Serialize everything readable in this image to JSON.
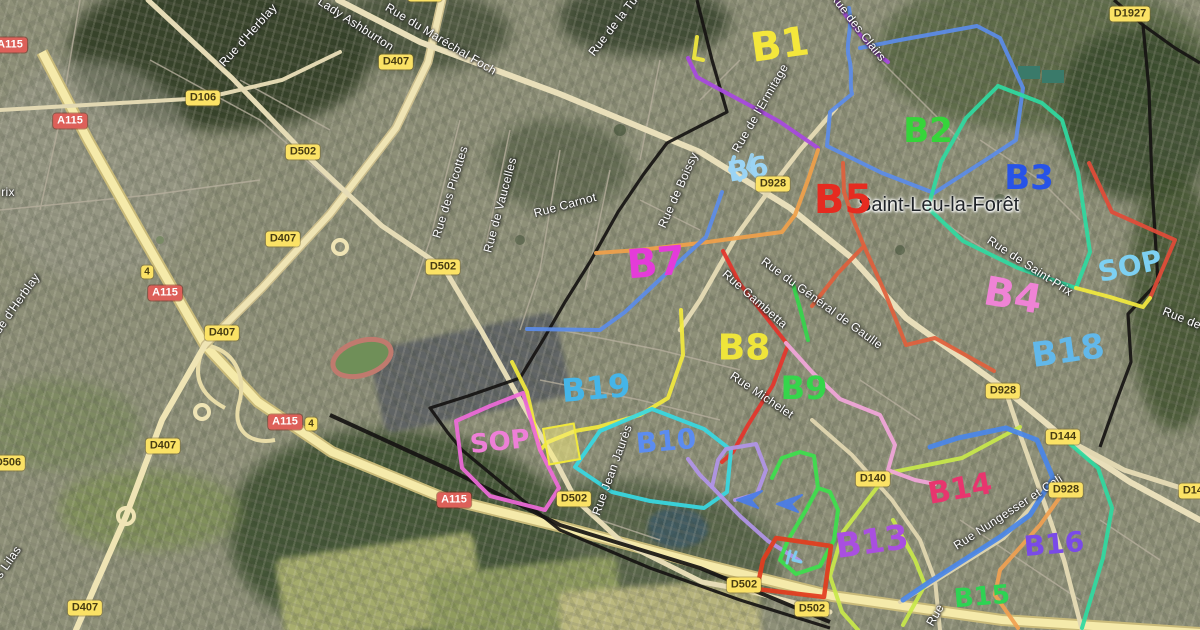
{
  "map": {
    "town_label": "Saint-Leu-la-Forêt",
    "road_badges": [
      {
        "text": "A115",
        "kind": "a",
        "x": 10,
        "y": 45
      },
      {
        "text": "D1927",
        "kind": "d",
        "x": 1130,
        "y": 14
      },
      {
        "text": "D106",
        "kind": "d",
        "x": 203,
        "y": 98
      },
      {
        "text": "A115",
        "kind": "a",
        "x": 70,
        "y": 121
      },
      {
        "text": "D502",
        "kind": "d",
        "x": 303,
        "y": 152
      },
      {
        "text": "D407",
        "kind": "d",
        "x": 396,
        "y": 62
      },
      {
        "text": "D407",
        "kind": "d",
        "x": 425,
        "y": -6
      },
      {
        "text": "D928",
        "kind": "d",
        "x": 773,
        "y": 184
      },
      {
        "text": "D407",
        "kind": "d",
        "x": 283,
        "y": 239
      },
      {
        "text": "D502",
        "kind": "d",
        "x": 443,
        "y": 267
      },
      {
        "text": "4",
        "kind": "sq",
        "x": 147,
        "y": 272
      },
      {
        "text": "A115",
        "kind": "a",
        "x": 165,
        "y": 293
      },
      {
        "text": "D407",
        "kind": "d",
        "x": 222,
        "y": 333
      },
      {
        "text": "A115",
        "kind": "a",
        "x": 285,
        "y": 422
      },
      {
        "text": "4",
        "kind": "sq",
        "x": 311,
        "y": 424
      },
      {
        "text": "D407",
        "kind": "d",
        "x": 163,
        "y": 446
      },
      {
        "text": "D506",
        "kind": "d",
        "x": 8,
        "y": 463
      },
      {
        "text": "D140",
        "kind": "d",
        "x": 873,
        "y": 479
      },
      {
        "text": "A115",
        "kind": "a",
        "x": 454,
        "y": 500
      },
      {
        "text": "D502",
        "kind": "d",
        "x": 574,
        "y": 499
      },
      {
        "text": "D502",
        "kind": "d",
        "x": 744,
        "y": 585
      },
      {
        "text": "D502",
        "kind": "d",
        "x": 812,
        "y": 609
      },
      {
        "text": "D407",
        "kind": "d",
        "x": 85,
        "y": 608
      },
      {
        "text": "D928",
        "kind": "d",
        "x": 1003,
        "y": 391
      },
      {
        "text": "D144",
        "kind": "d",
        "x": 1063,
        "y": 437
      },
      {
        "text": "D928",
        "kind": "d",
        "x": 1066,
        "y": 490
      },
      {
        "text": "D144",
        "kind": "d",
        "x": 1196,
        "y": 491
      }
    ],
    "street_labels": [
      {
        "text": "Lady Ashburton",
        "x": 356,
        "y": 24,
        "rot": 33
      },
      {
        "text": "Rue du Maréchal Foch",
        "x": 441,
        "y": 39,
        "rot": 31
      },
      {
        "text": "Rue de la Tu",
        "x": 613,
        "y": 26,
        "rot": -52
      },
      {
        "text": "Rue d'Herblay",
        "x": 248,
        "y": 35,
        "rot": -48
      },
      {
        "text": "Rue d'Herblay",
        "x": 14,
        "y": 307,
        "rot": -55
      },
      {
        "text": "rix",
        "x": 8,
        "y": 192,
        "rot": 0
      },
      {
        "text": "Rue des Picottes",
        "x": 450,
        "y": 192,
        "rot": -73
      },
      {
        "text": "Rue de Vaucelles",
        "x": 500,
        "y": 205,
        "rot": -75
      },
      {
        "text": "Rue Carnot",
        "x": 565,
        "y": 205,
        "rot": -15
      },
      {
        "text": "Rue de Boissy",
        "x": 678,
        "y": 190,
        "rot": -66
      },
      {
        "text": "Rue de l'Ermitage",
        "x": 760,
        "y": 108,
        "rot": -60
      },
      {
        "text": "Rue des Clairs",
        "x": 858,
        "y": 27,
        "rot": 52
      },
      {
        "text": "Rue du Général de Gaulle",
        "x": 822,
        "y": 303,
        "rot": 36
      },
      {
        "text": "Rue Gambetta",
        "x": 755,
        "y": 299,
        "rot": 41
      },
      {
        "text": "Rue de Saint-Prix",
        "x": 1030,
        "y": 266,
        "rot": 33
      },
      {
        "text": "Rue de",
        "x": 1182,
        "y": 318,
        "rot": 22
      },
      {
        "text": "Rue Michelet",
        "x": 762,
        "y": 395,
        "rot": 34
      },
      {
        "text": "Rue Jean Jaurès",
        "x": 612,
        "y": 470,
        "rot": -70
      },
      {
        "text": "Rue Nungesser et Coli",
        "x": 1008,
        "y": 512,
        "rot": -33
      },
      {
        "text": "s Lilas",
        "x": 8,
        "y": 562,
        "rot": -55
      },
      {
        "text": "Rue",
        "x": 935,
        "y": 615,
        "rot": -60
      }
    ],
    "route_labels": [
      {
        "text": "B1",
        "color": "#f4e73b",
        "x": 780,
        "y": 45,
        "size": 40,
        "rot": -8
      },
      {
        "text": "B2",
        "color": "#35d53a",
        "x": 928,
        "y": 131,
        "size": 34,
        "rot": 0
      },
      {
        "text": "B3",
        "color": "#2753e8",
        "x": 1029,
        "y": 178,
        "size": 34,
        "rot": 0
      },
      {
        "text": "B4",
        "color": "#ef83d5",
        "x": 1013,
        "y": 296,
        "size": 40,
        "rot": 10
      },
      {
        "text": "B5",
        "color": "#e62b20",
        "x": 843,
        "y": 200,
        "size": 40,
        "rot": 0
      },
      {
        "text": "B6",
        "color": "#9bd4f5",
        "x": 748,
        "y": 169,
        "size": 28,
        "rot": -10
      },
      {
        "text": "B7",
        "color": "#e43bd9",
        "x": 656,
        "y": 263,
        "size": 40,
        "rot": -5
      },
      {
        "text": "B8",
        "color": "#efe53a",
        "x": 744,
        "y": 348,
        "size": 36,
        "rot": 0
      },
      {
        "text": "B9",
        "color": "#35d54b",
        "x": 804,
        "y": 388,
        "size": 32,
        "rot": 0
      },
      {
        "text": "B10",
        "color": "#5b8cf0",
        "x": 666,
        "y": 441,
        "size": 28,
        "rot": -5
      },
      {
        "text": "B13",
        "color": "#a94fe0",
        "x": 872,
        "y": 542,
        "size": 34,
        "rot": -8
      },
      {
        "text": "B14",
        "color": "#e8356e",
        "x": 960,
        "y": 489,
        "size": 30,
        "rot": -10
      },
      {
        "text": "B15",
        "color": "#2ed353",
        "x": 982,
        "y": 597,
        "size": 26,
        "rot": -5
      },
      {
        "text": "B16",
        "color": "#7a4ae8",
        "x": 1054,
        "y": 544,
        "size": 28,
        "rot": -5
      },
      {
        "text": "B18",
        "color": "#62b8ea",
        "x": 1068,
        "y": 351,
        "size": 34,
        "rot": -8
      },
      {
        "text": "B19",
        "color": "#45b5e8",
        "x": 596,
        "y": 388,
        "size": 32,
        "rot": -5
      },
      {
        "text": "SOP",
        "color": "#7dd0f2",
        "x": 1130,
        "y": 266,
        "size": 28,
        "rot": -12
      },
      {
        "text": "SOP",
        "color": "#ee7fd7",
        "x": 500,
        "y": 442,
        "size": 26,
        "rot": -6
      }
    ],
    "routes": [
      {
        "name": "route-b1-blue",
        "color": "#5b8ce8",
        "width": 4,
        "path": "M 849,8 C 853,28 845,44 849,58 C 853,72 849,84 852,94 L 830,112 L 827,146 L 882,173 L 934,193 L 987,159 L 1016,140 L 1023,88 L 1000,38 L 977,26 L 900,40 L 860,48"
      },
      {
        "name": "route-purple-clairs",
        "color": "#a848e0",
        "width": 4,
        "path": "M 836,0 C 845,15 855,30 876,53 L 888,62"
      },
      {
        "name": "route-purple-ermitage",
        "color": "#a848e0",
        "width": 4,
        "path": "M 688,58 L 697,77 C 720,90 750,105 780,122 L 818,148"
      },
      {
        "name": "route-orange-upper",
        "color": "#f0a04a",
        "width": 4,
        "path": "M 818,150 L 808,180 L 795,215 L 782,232 L 700,243 L 640,250 L 596,253"
      },
      {
        "name": "route-orange-lower",
        "color": "#f0a052",
        "width": 4,
        "path": "M 1065,490 L 1040,525 L 1000,570 L 995,595 L 1018,628"
      },
      {
        "name": "route-teal-loop",
        "color": "#2fd9a0",
        "width": 4,
        "path": "M 998,86 L 1042,103 L 1062,120 L 1078,172 L 1090,252 L 1076,288 L 1018,268 L 963,241 L 928,208 L 941,162 L 966,118 L 998,86"
      },
      {
        "name": "route-teal-lower",
        "color": "#2fd9a0",
        "width": 4,
        "path": "M 1062,437 L 1098,468 L 1112,508 L 1103,558 L 1082,628"
      },
      {
        "name": "route-green-b9",
        "color": "#35d54b",
        "width": 4,
        "path": "M 793,284 L 801,312 L 808,340"
      },
      {
        "name": "route-red-gambetta",
        "color": "#e5352b",
        "width": 4,
        "path": "M 723,251 L 740,284 L 762,312 L 788,345 L 773,385 L 748,425 L 733,452 L 722,462"
      },
      {
        "name": "route-salmon",
        "color": "#e0603c",
        "width": 4,
        "path": "M 843,163 L 844,192 L 853,219 L 864,246 L 886,295 L 906,345 L 935,338 L 994,371"
      },
      {
        "name": "route-salmon-branch",
        "color": "#e0603c",
        "width": 4,
        "path": "M 864,246 L 838,273 L 812,306"
      },
      {
        "name": "route-sop-red",
        "color": "#e24b38",
        "width": 4,
        "path": "M 1089,163 L 1112,212 L 1175,240 L 1150,298"
      },
      {
        "name": "route-sop-yellow",
        "color": "#f2e93e",
        "width": 4,
        "path": "M 1076,288 L 1110,297 L 1143,307 L 1150,298"
      },
      {
        "name": "route-yellow-main",
        "color": "#f2e93e",
        "width": 4,
        "path": "M 681,310 L 683,355 L 668,398 L 640,415 L 598,427 L 575,431 L 548,442 L 540,450 L 527,392 L 512,362"
      },
      {
        "name": "route-chartreuse-a",
        "color": "#c8e84a",
        "width": 4,
        "path": "M 1020,427 L 962,458 L 888,473 L 843,532 L 830,576 L 842,612 L 858,630"
      },
      {
        "name": "route-chartreuse-b",
        "color": "#c8e84a",
        "width": 4,
        "path": "M 893,520 L 915,560 L 925,585 L 903,625"
      },
      {
        "name": "route-blue-nungesser",
        "color": "#4a86e8",
        "width": 5,
        "path": "M 903,600 L 928,583 L 1000,537 L 1030,515 L 1053,478 L 1037,440 L 1006,428 L 958,438 L 930,447"
      },
      {
        "name": "route-cyan-b10",
        "color": "#38d8e2",
        "width": 4,
        "path": "M 575,467 L 600,431 L 652,409 L 704,429 L 731,450 L 727,492 L 704,508 L 650,501 L 612,492 L 575,467"
      },
      {
        "name": "route-lavender",
        "color": "#b294e8",
        "width": 4,
        "path": "M 688,459 L 700,475 L 712,487 L 740,516 L 768,541 L 800,561"
      },
      {
        "name": "route-lavender-rect",
        "color": "#b294e8",
        "width": 4,
        "path": "M 712,487 L 718,460 L 726,449 L 756,444 L 766,470 L 757,494 L 735,500"
      },
      {
        "name": "route-green-poly",
        "color": "#3ce04c",
        "width": 4,
        "path": "M 772,478 L 782,458 L 800,452 L 814,456 L 818,488 L 806,510 L 788,540 L 780,560 L 796,574 L 820,566 L 834,540 L 838,510 L 830,492 L 818,488"
      },
      {
        "name": "route-red-rect",
        "color": "#e23c1e",
        "width": 4.5,
        "path": "M 776,538 L 831,546 L 824,597 L 757,589 L 763,560 L 776,538"
      },
      {
        "name": "route-pink-poly",
        "color": "#ee6ad8",
        "width": 4,
        "path": "M 523,393 L 490,406 L 456,421 L 462,468 L 490,496 L 545,510 L 559,488 L 540,450 L 523,393"
      },
      {
        "name": "route-pink-light",
        "color": "#f2a6da",
        "width": 4,
        "path": "M 786,343 L 812,372 L 840,399 L 880,415 L 895,445 L 888,470 L 915,480 L 935,484"
      },
      {
        "name": "route-blue-left",
        "color": "#5b8ce8",
        "width": 4,
        "path": "M 722,192 L 706,237 L 670,270 L 625,312 L 600,330 L 527,329"
      },
      {
        "name": "mark-b6-squiggle",
        "color": "#9bd4f5",
        "width": 4,
        "path": "M 734,157 L 730,170 L 740,180 M 752,155 L 748,168 L 758,178"
      },
      {
        "name": "mark-yellow-hook",
        "color": "#f2e93e",
        "width": 4,
        "path": "M 697,37 L 694,58 L 703,60"
      },
      {
        "name": "mark-cyan-scribble",
        "color": "#7dd0f2",
        "width": 3,
        "path": "M 790,551 L 787,563 M 796,552 L 793,560 L 801,562"
      },
      {
        "name": "arrow-blue-1",
        "color": "#4a7de8",
        "width": 2,
        "fill": true,
        "path": "M 762,491 L 737,500 L 758,508 L 751,500 Z"
      },
      {
        "name": "arrow-blue-2",
        "color": "#4a7de8",
        "width": 2,
        "fill": true,
        "path": "M 802,495 L 777,504 L 798,512 L 791,504 Z"
      }
    ],
    "boundaries": [
      {
        "name": "boundary-main",
        "path": "M 697,0 L 712,60 L 727,112 L 667,143 L 643,175 L 618,212 L 590,262 L 565,302 L 543,340 L 520,378 L 468,396 L 430,408 L 448,433 L 462,450 L 520,498 L 560,530 L 650,568 L 740,600 L 830,628"
      },
      {
        "name": "boundary-right",
        "path": "M 1114,0 L 1143,25 L 1149,90 L 1152,185 L 1158,282 L 1128,314 L 1131,362 L 1116,402 L 1100,447"
      },
      {
        "name": "boundary-right-branch",
        "path": "M 1143,25 L 1175,48 L 1200,63"
      },
      {
        "name": "railway",
        "path": "M 330,415 L 450,470 L 560,525 L 700,568 L 830,622"
      }
    ],
    "highlights": [
      {
        "name": "yellow-block",
        "x": 545,
        "y": 425,
        "w": 33,
        "h": 38,
        "rot": -10
      }
    ]
  }
}
